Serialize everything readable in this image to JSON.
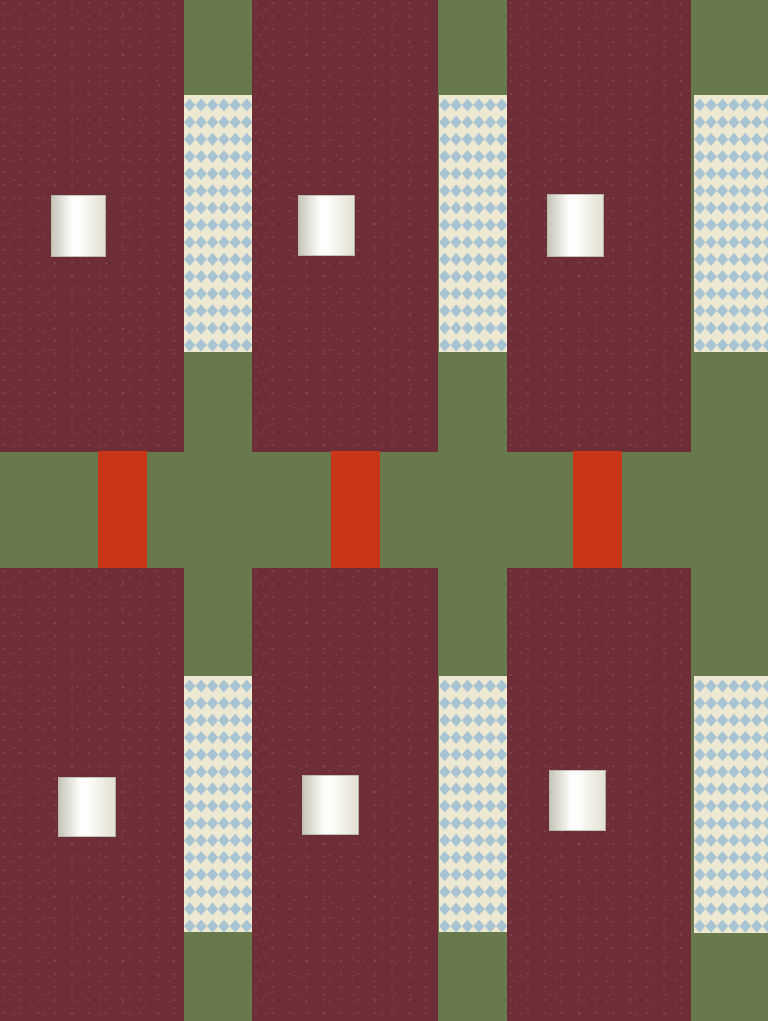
{
  "canvas": {
    "width": 768,
    "height": 1021,
    "background_color": "#68794e"
  },
  "palette": {
    "field_green": "#68794e",
    "block_maroon": "#6e2e37",
    "bar_red": "#c83517",
    "diamond_blue": "#a8c3d2",
    "diamond_cream": "#ece8d1",
    "square_left": "#c8c6b8",
    "square_bright": "#fdfdfb",
    "square_right": "#e2e0d1"
  },
  "maroon_blocks": [
    {
      "x": 0,
      "y": 0,
      "w": 184,
      "h": 452
    },
    {
      "x": 252,
      "y": 0,
      "w": 186,
      "h": 452
    },
    {
      "x": 507,
      "y": 0,
      "w": 184,
      "h": 452
    },
    {
      "x": 0,
      "y": 568,
      "w": 184,
      "h": 453
    },
    {
      "x": 252,
      "y": 568,
      "w": 186,
      "h": 453
    },
    {
      "x": 507,
      "y": 568,
      "w": 184,
      "h": 453
    }
  ],
  "diamond_strips": [
    {
      "x": 184,
      "y": 95,
      "w": 68,
      "h": 257
    },
    {
      "x": 439,
      "y": 95,
      "w": 68,
      "h": 257
    },
    {
      "x": 694,
      "y": 95,
      "w": 74,
      "h": 257
    },
    {
      "x": 184,
      "y": 676,
      "w": 68,
      "h": 256
    },
    {
      "x": 439,
      "y": 676,
      "w": 68,
      "h": 256
    },
    {
      "x": 694,
      "y": 676,
      "w": 74,
      "h": 257
    }
  ],
  "red_bars": [
    {
      "x": 98,
      "y": 451,
      "w": 49,
      "h": 117
    },
    {
      "x": 331,
      "y": 451,
      "w": 49,
      "h": 117
    },
    {
      "x": 573,
      "y": 451,
      "w": 49,
      "h": 117
    }
  ],
  "gradient_squares": [
    {
      "x": 51,
      "y": 195,
      "w": 55,
      "h": 62
    },
    {
      "x": 298,
      "y": 195,
      "w": 57,
      "h": 61
    },
    {
      "x": 547,
      "y": 194,
      "w": 57,
      "h": 63
    },
    {
      "x": 58,
      "y": 777,
      "w": 58,
      "h": 60
    },
    {
      "x": 302,
      "y": 775,
      "w": 57,
      "h": 60
    },
    {
      "x": 549,
      "y": 770,
      "w": 57,
      "h": 61
    }
  ],
  "diamond_pattern": {
    "cell_w": 11.4,
    "cell_h": 17.15,
    "diamond_h": 13,
    "first_col_x": 5.7,
    "first_row_y": 10
  }
}
